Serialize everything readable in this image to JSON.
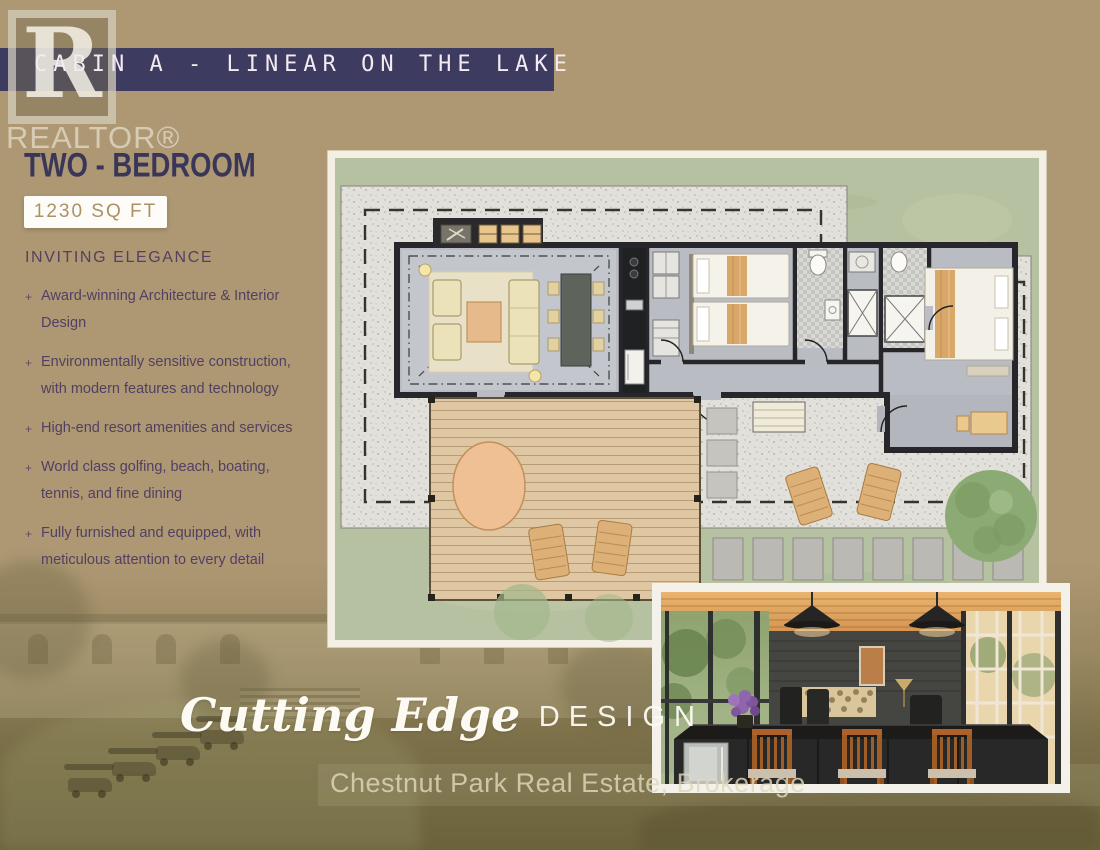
{
  "page": {
    "colors": {
      "background_tan": "#ad9873",
      "header_navy": "#3d3b60",
      "body_purple": "#523f61",
      "badge_tan_text": "#ac9166",
      "footer_cream": "#e1d8bc",
      "plan_grass": "#b6c1a1",
      "plan_gravel": "#e1e0da"
    }
  },
  "header": {
    "title": "CABIN A - LINEAR ON THE LAKE"
  },
  "realtor_logo": {
    "letter": "R",
    "label": "REALTOR®"
  },
  "listing": {
    "bedrooms_title": "TWO - BEDROOM",
    "sqft_badge": "1230 SQ FT",
    "features_heading": "INVITING ELEGANCE",
    "bullet_marker": "+",
    "features": [
      "Award-winning Architecture & Interior Design",
      "Environmentally sensitive construction, with modern features and technology",
      "High-end resort amenities and services",
      "World class golfing, beach, boating, tennis, and fine dining",
      "Fully furnished and equipped, with meticulous attention to every detail"
    ]
  },
  "footer": {
    "tagline_script": "Cutting Edge",
    "tagline_plain": "DESIGN",
    "brokerage": "Chestnut Park Real Estate, Brokerage"
  }
}
